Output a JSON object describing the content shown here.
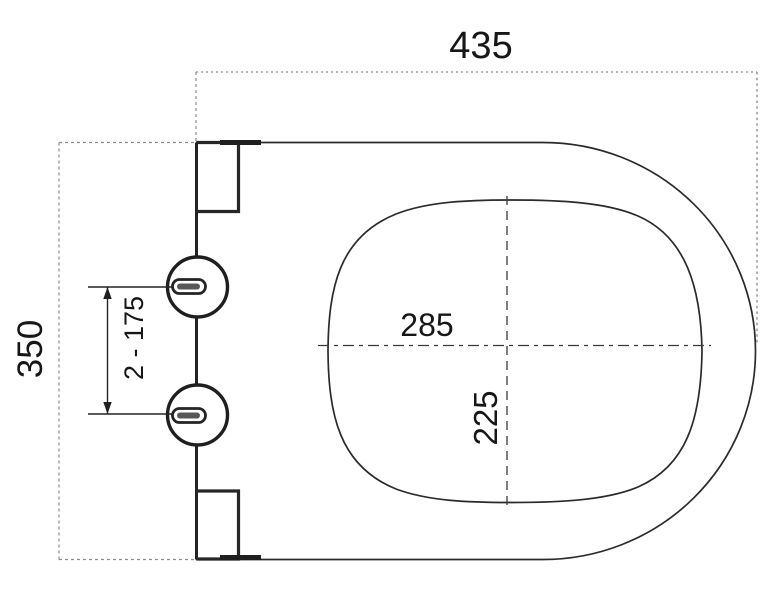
{
  "drawing": {
    "type": "technical-dimension-drawing",
    "subject": "toilet-seat-top-view",
    "labels": {
      "overall_width": "435",
      "overall_height": "350",
      "hinge_hole_spacing": "2 - 175",
      "inner_opening_width": "285",
      "inner_opening_depth": "225"
    },
    "colors": {
      "outline": "#2b2b2b",
      "construction": "#8c8c8c",
      "centerline": "#3a3a3a",
      "text": "#161616",
      "background": "#ffffff"
    }
  }
}
